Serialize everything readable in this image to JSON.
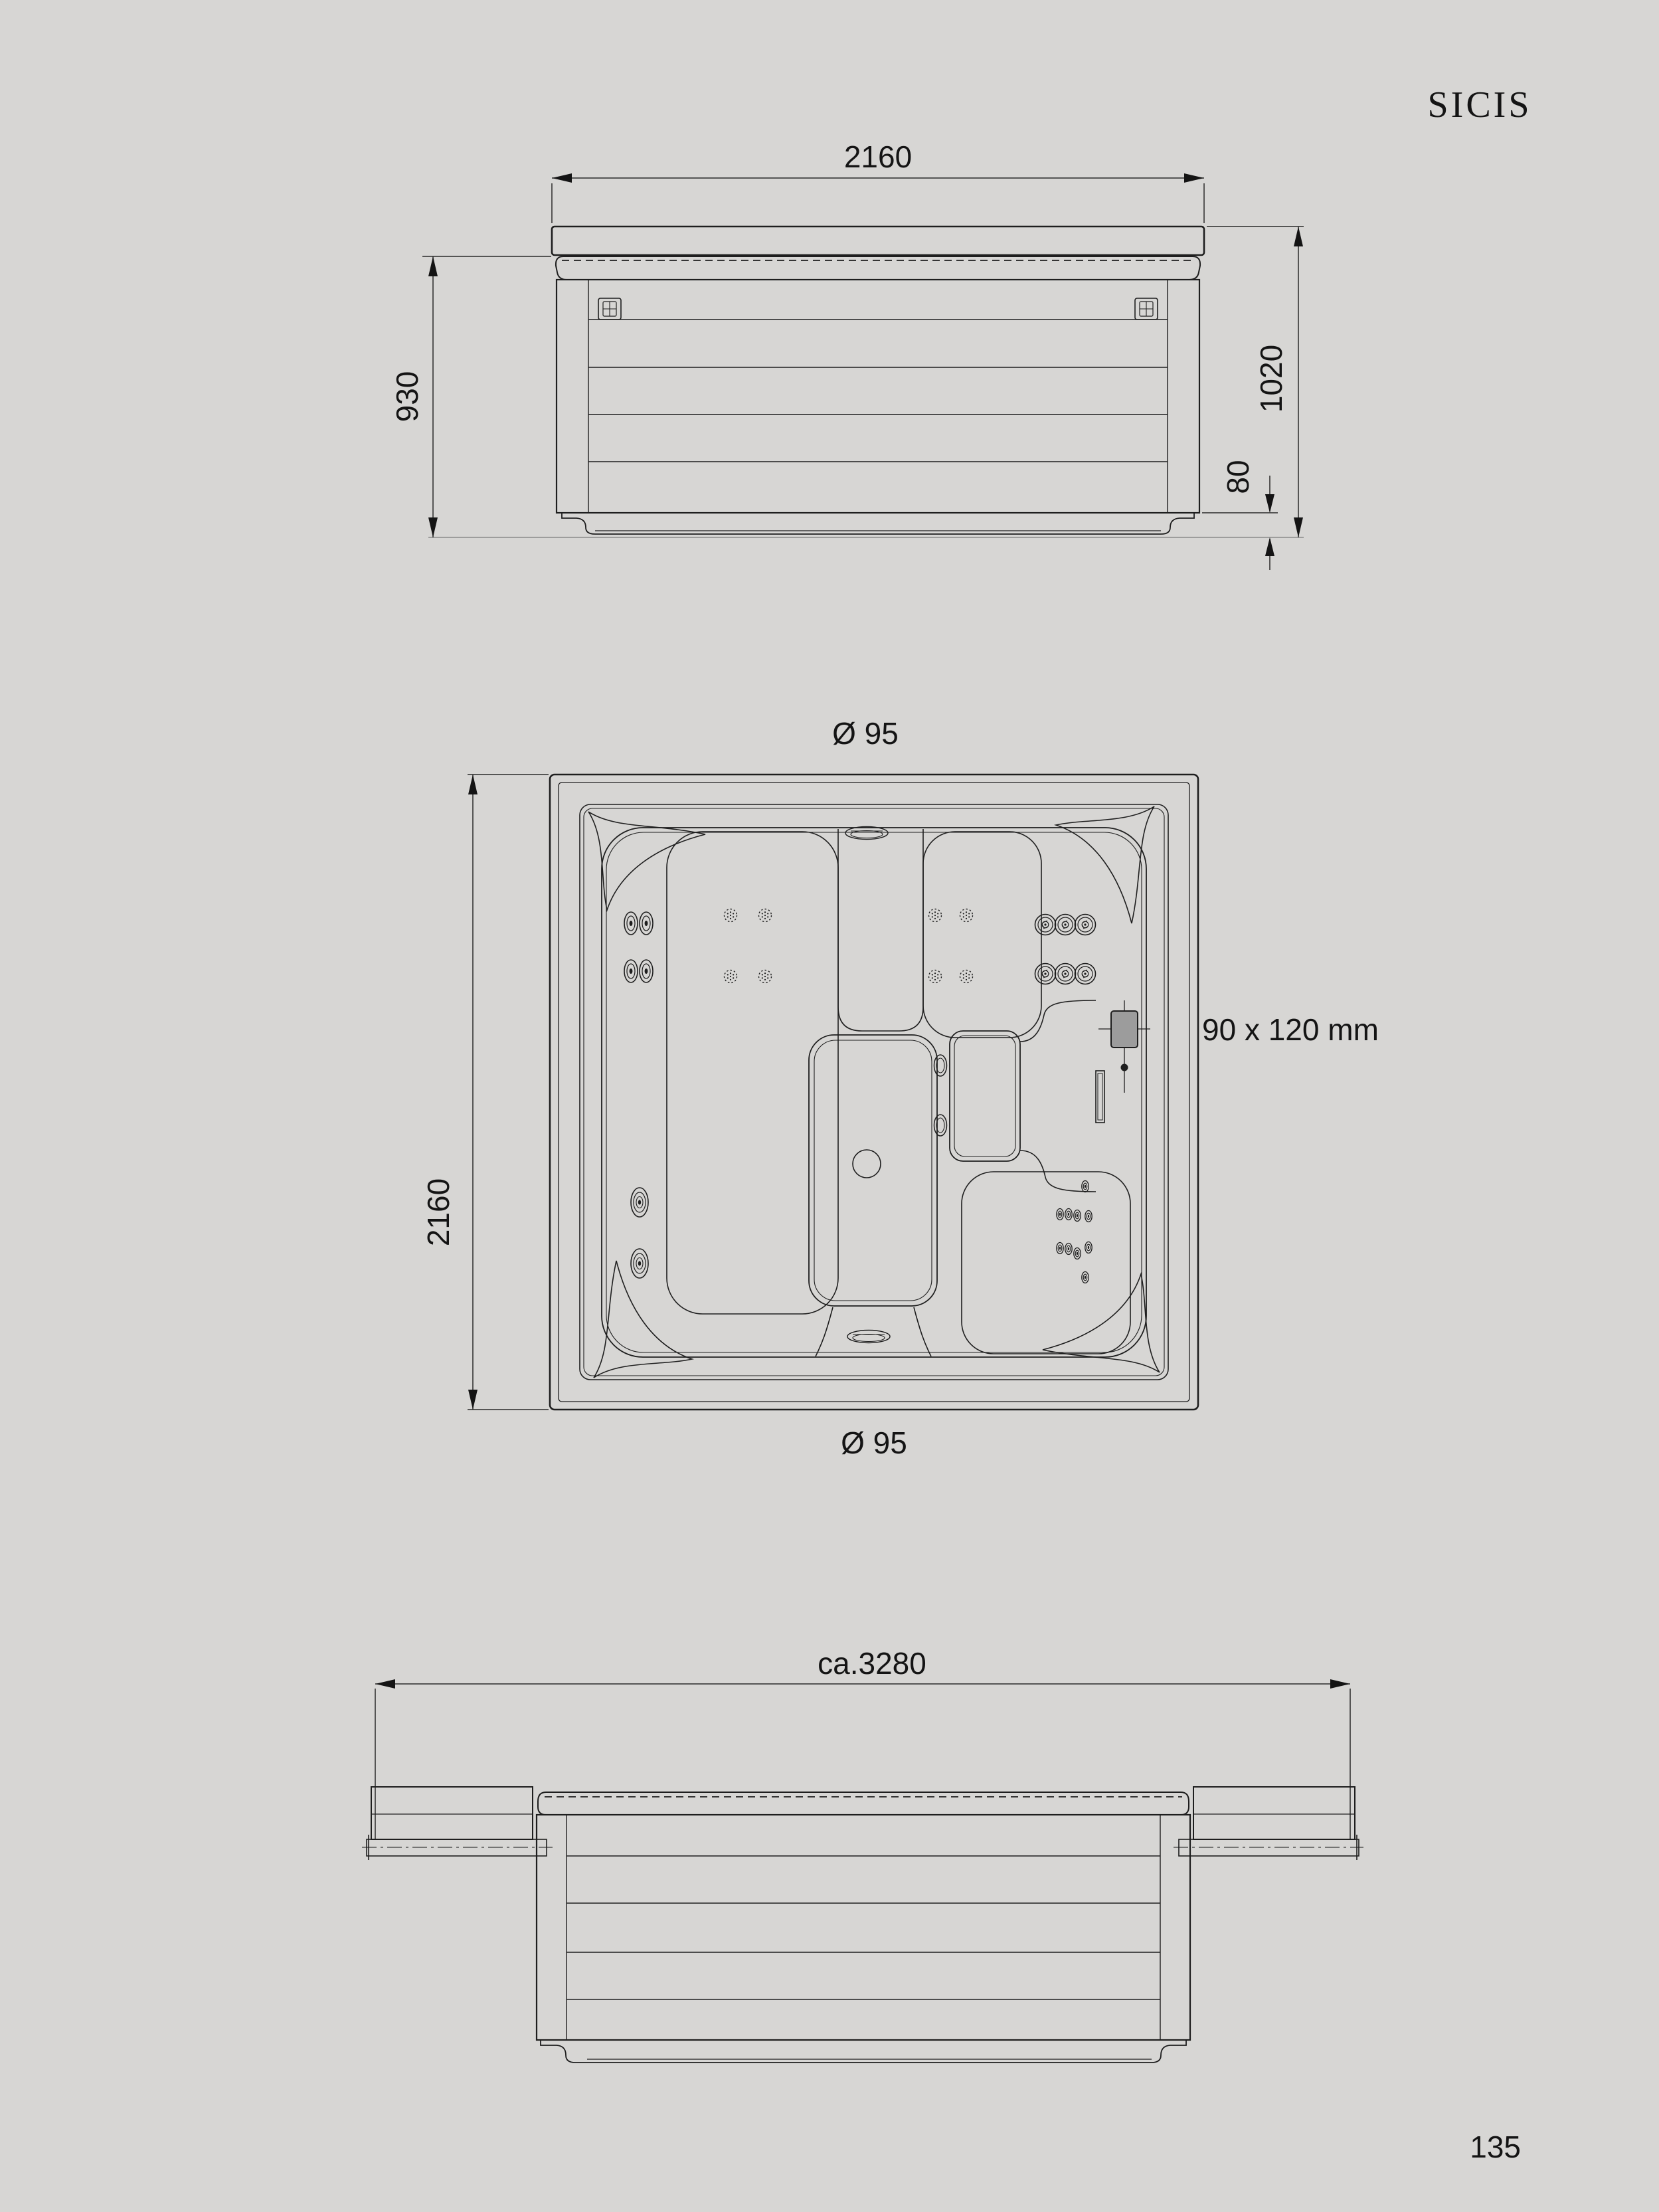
{
  "brand": {
    "logo": "SICIS"
  },
  "footer": {
    "page_number": "135"
  },
  "colors": {
    "background": "#d7d6d4",
    "line": "#1e1e1e",
    "extension_line": "#8a8a8a",
    "control_panel_fill": "#9c9c9c"
  },
  "front_view": {
    "name": "front elevation with closed cover",
    "width_label": "2160",
    "body_height_label": "930",
    "total_height_label": "1020",
    "base_height_label": "80"
  },
  "plan_view": {
    "name": "top plan view of spa",
    "diameter_top_label": "Ø 95",
    "diameter_bottom_label": "Ø 95",
    "depth_label": "2160",
    "control_panel_label": "90 x 120 mm"
  },
  "side_view": {
    "name": "elevation with cover folded open",
    "total_width_label": "ca.3280"
  }
}
